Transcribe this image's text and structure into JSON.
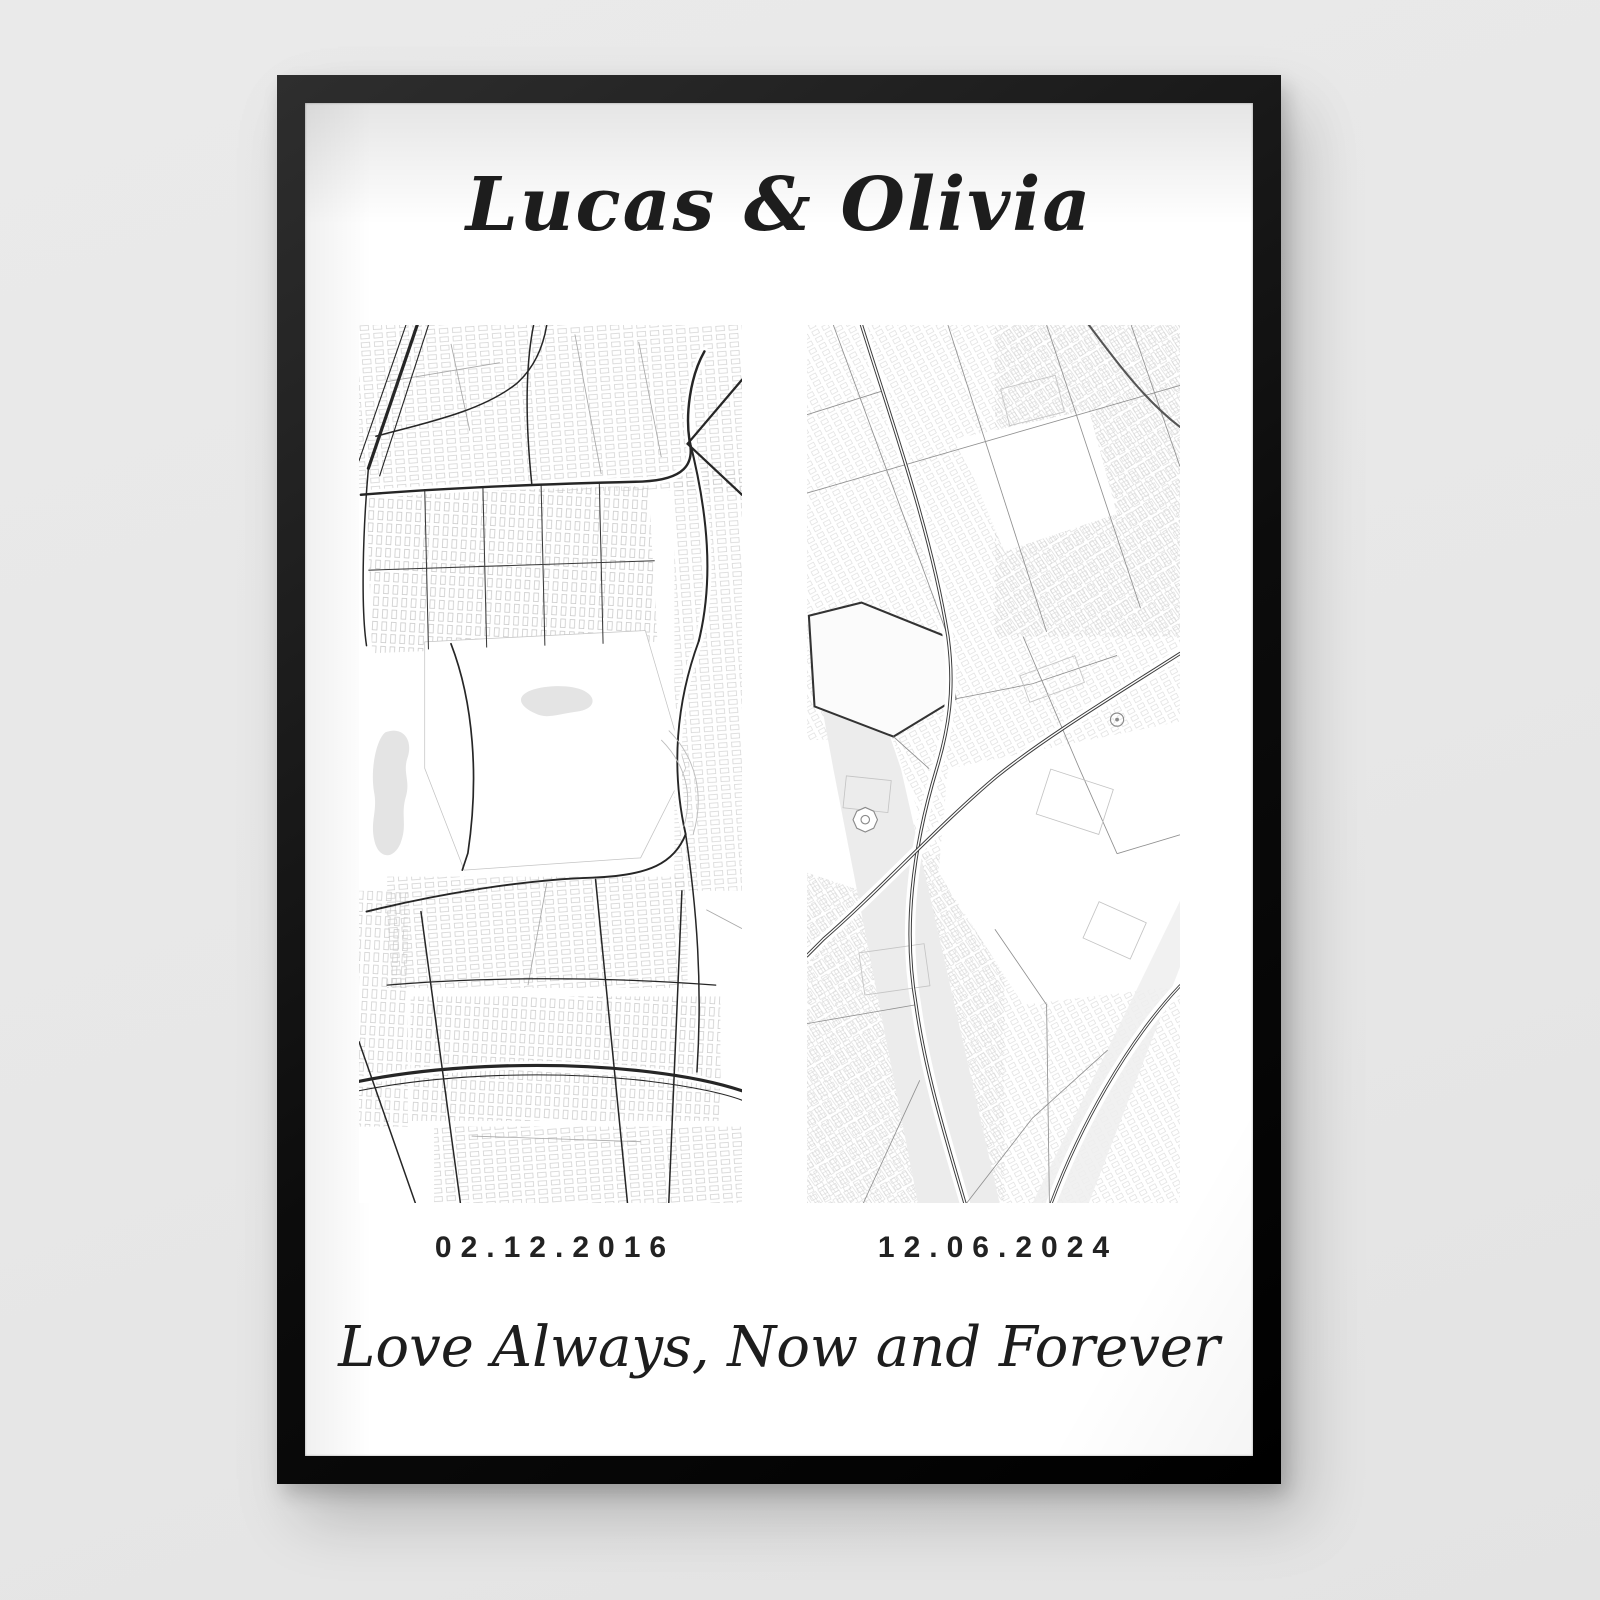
{
  "poster": {
    "title": "Lucas & Olivia",
    "caption": "Love Always, Now and Forever",
    "left_map": {
      "date": "02.12.2016"
    },
    "right_map": {
      "date": "12.06.2024"
    }
  },
  "colors": {
    "page_bg": "#e7e7e7",
    "frame": "#141414",
    "paper": "#ffffff",
    "ink": "#1d1d1d",
    "road_dark": "#262626",
    "road_mid": "#8f8f8f",
    "building_outline": "#cbcbcb",
    "pond_water": "#e4e4e4",
    "river_band": "#ececec"
  }
}
